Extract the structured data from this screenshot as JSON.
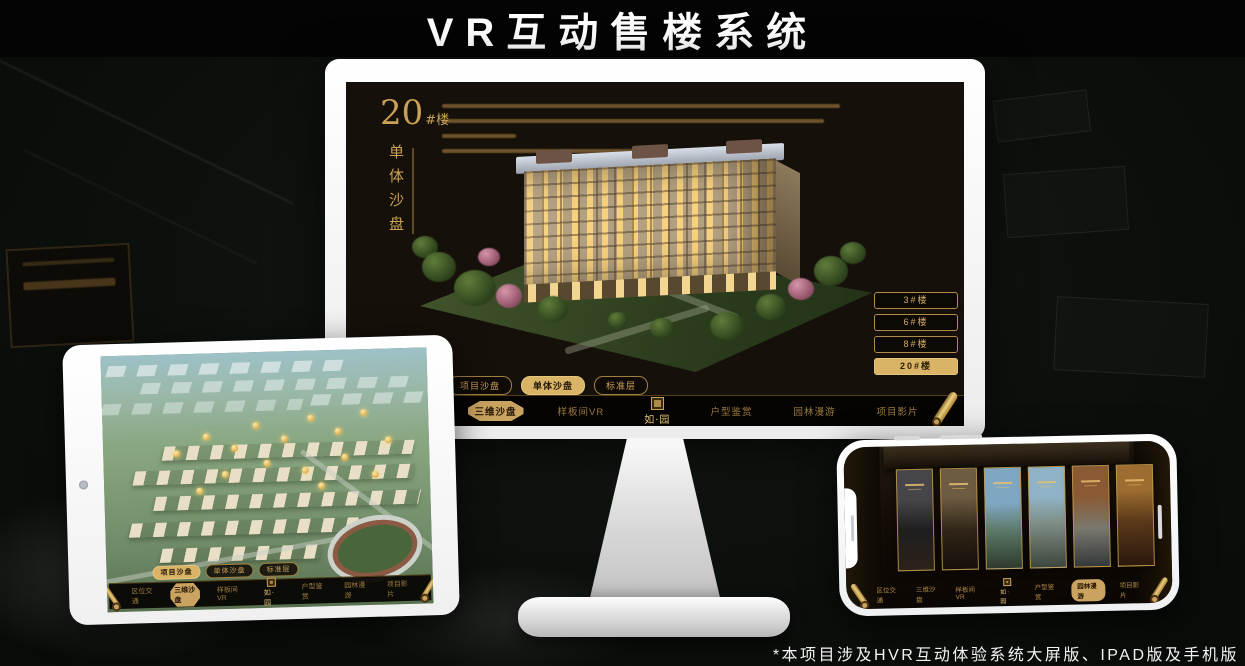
{
  "title": "VR互动售楼系统",
  "caption": "*本项目涉及HVR互动体验系统大屏版、IPAD版及手机版",
  "colors": {
    "accent_gold": "#c9a35f",
    "active_gold": "#d9b467",
    "screen_bg": "#16100a"
  },
  "icons": {
    "scroll": "scroll-icon",
    "seal": "seal-icon",
    "camera": "camera-icon"
  },
  "monitor": {
    "heading_number": "20",
    "heading_suffix": "#楼",
    "vertical_title": "单体沙盘",
    "building_buttons": [
      {
        "label": "3#楼"
      },
      {
        "label": "6#楼"
      },
      {
        "label": "8#楼"
      },
      {
        "label": "20#楼"
      }
    ],
    "tabs": [
      {
        "label": "项目沙盘"
      },
      {
        "label": "单体沙盘"
      },
      {
        "label": "标准层"
      }
    ],
    "nav": {
      "items_left": [
        "区位交通",
        "三维沙盘",
        "样板间VR"
      ],
      "items_right": [
        "户型鉴赏",
        "园林漫游",
        "项目影片"
      ],
      "active_item": "三维沙盘",
      "logo": "如·园"
    }
  },
  "ipad": {
    "tabs": [
      {
        "label": "项目沙盘"
      },
      {
        "label": "单体沙盘"
      },
      {
        "label": "标准层"
      }
    ],
    "nav": {
      "items_left": [
        "区位交通",
        "三维沙盘",
        "样板间VR"
      ],
      "items_right": [
        "户型鉴赏",
        "园林漫游",
        "项目影片"
      ],
      "active_item": "三维沙盘",
      "logo": "如·园"
    }
  },
  "phone": {
    "nav": {
      "items_left": [
        "区位交通",
        "三维沙盘",
        "样板间VR"
      ],
      "items_right": [
        "户型鉴赏",
        "园林漫游",
        "项目影片"
      ],
      "active_item": "园林漫游",
      "logo": "如·园"
    }
  }
}
